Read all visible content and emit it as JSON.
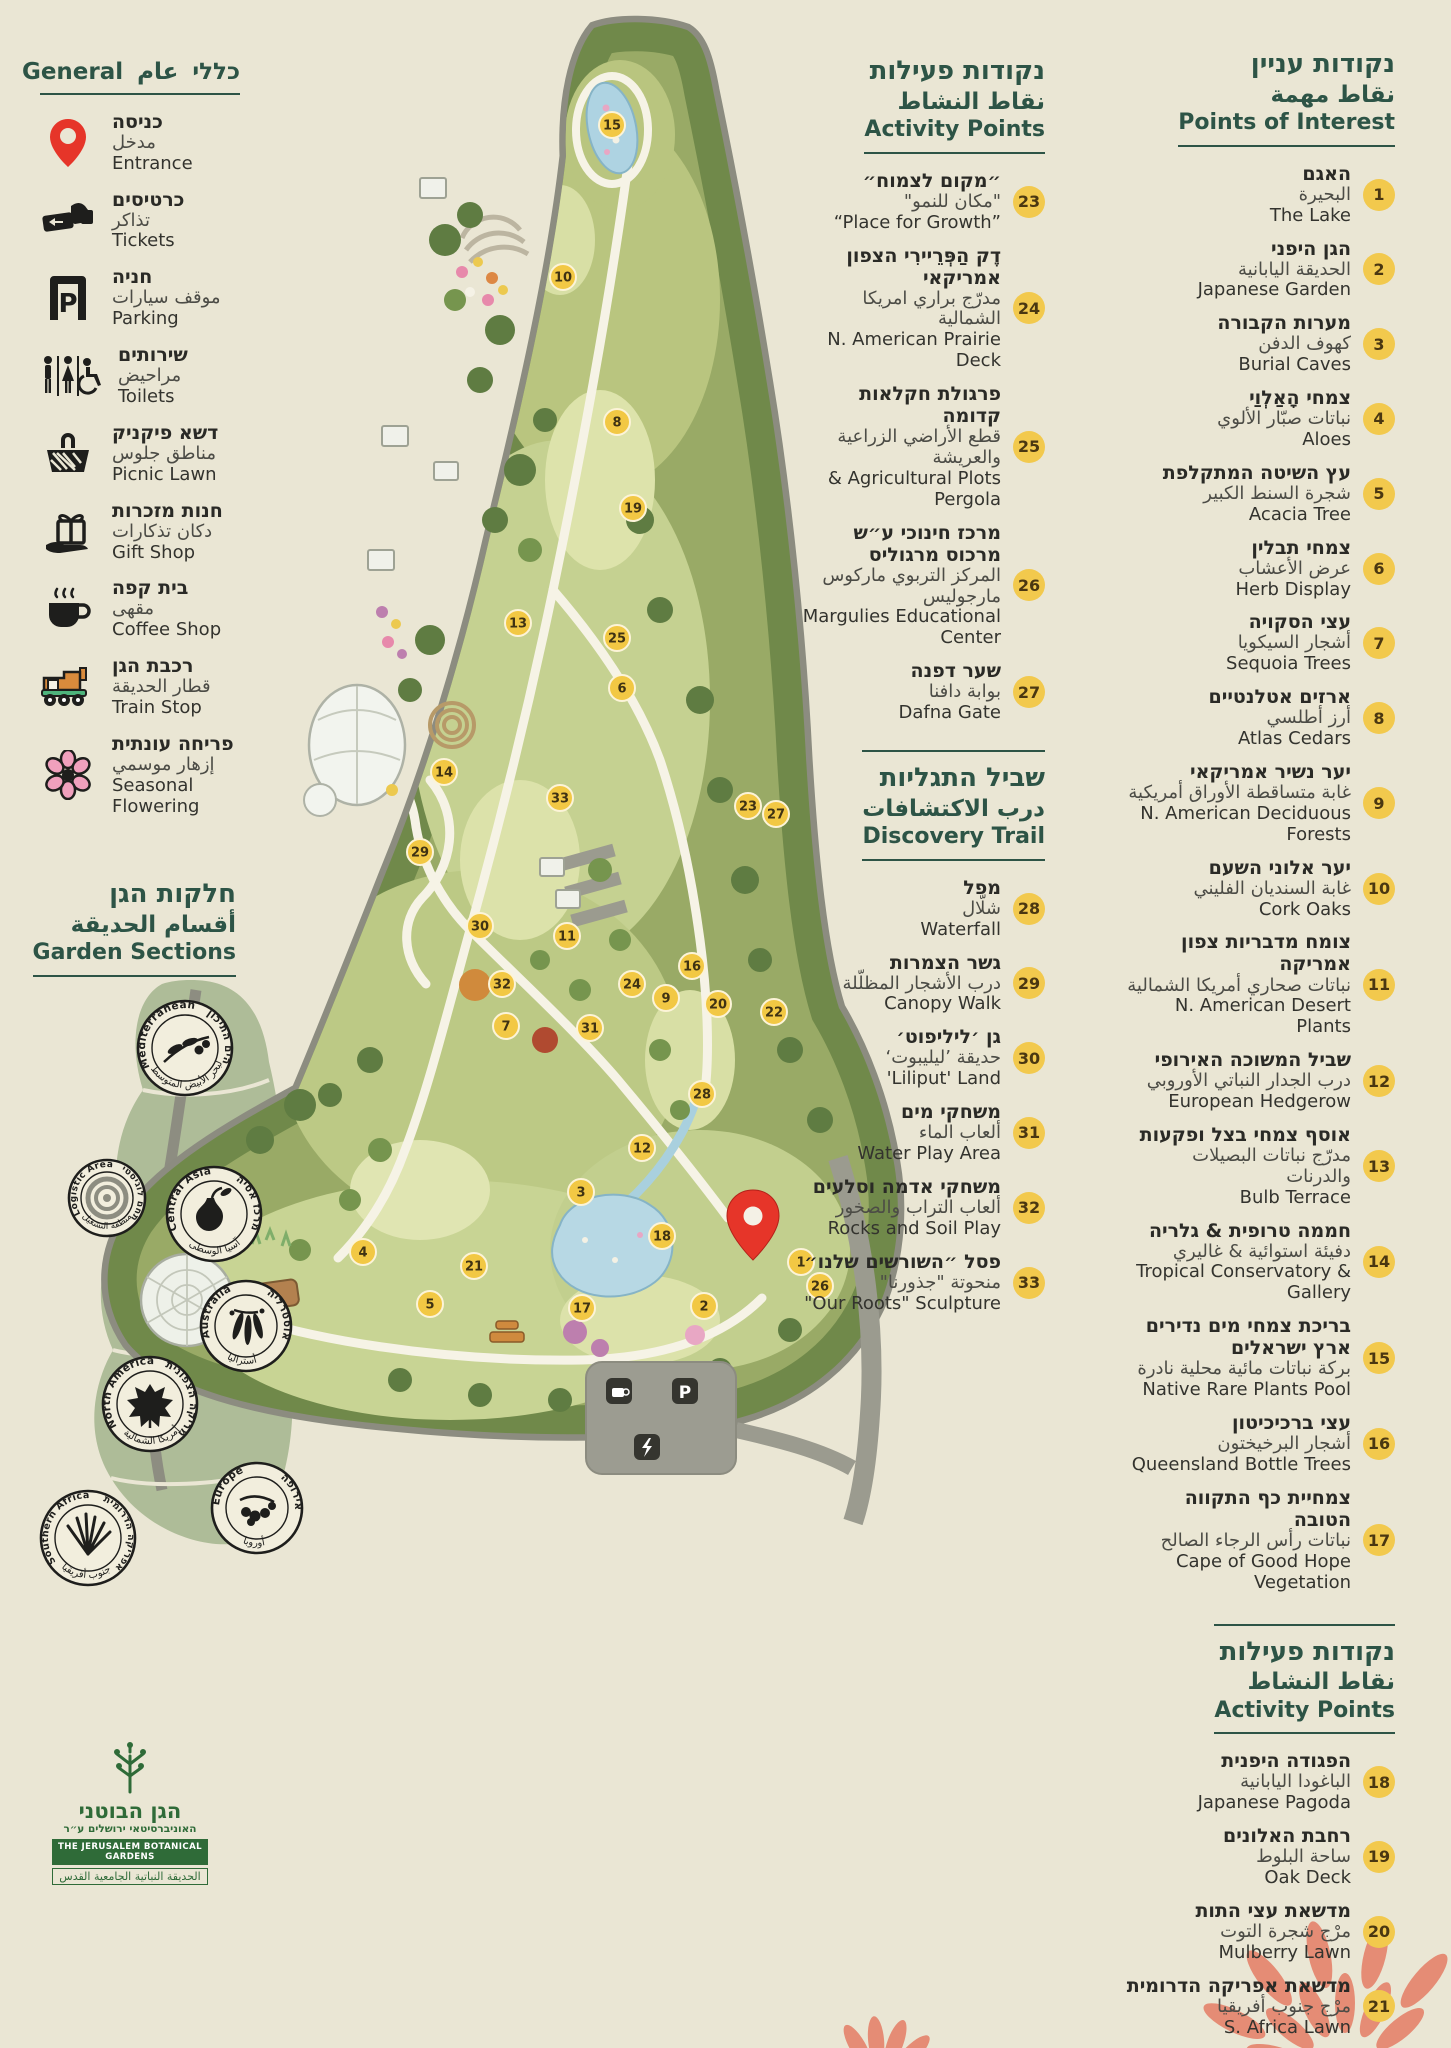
{
  "page": {
    "background": "#eae6d4",
    "accent_green": "#2d5446",
    "badge_yellow": "#f2c94d",
    "pin_red": "#e63529",
    "coral": "#e58c75"
  },
  "general_legend": {
    "title_he": "כללי",
    "title_ar": "عام",
    "title_en": "General",
    "items": [
      {
        "icon": "entrance-pin-icon",
        "he": "כניסה",
        "ar": "مدخل",
        "en": "Entrance"
      },
      {
        "icon": "tickets-icon",
        "he": "כרטיסים",
        "ar": "تذاكر",
        "en": "Tickets"
      },
      {
        "icon": "parking-icon",
        "he": "חניה",
        "ar": "موقف سيارات",
        "en": "Parking"
      },
      {
        "icon": "toilets-icon",
        "he": "שירותים",
        "ar": "مراحيض",
        "en": "Toilets"
      },
      {
        "icon": "picnic-basket-icon",
        "he": "דשא פיקניק",
        "ar": "مناطق جلوس",
        "en": "Picnic Lawn"
      },
      {
        "icon": "gift-shop-icon",
        "he": "חנות מזכרות",
        "ar": "دكان تذكارات",
        "en": "Gift Shop"
      },
      {
        "icon": "coffee-cup-icon",
        "he": "בית קפה",
        "ar": "مقهى",
        "en": "Coffee Shop"
      },
      {
        "icon": "train-icon",
        "he": "רכבת הגן",
        "ar": "قطار الحديقة",
        "en": "Train Stop"
      },
      {
        "icon": "flower-icon",
        "he": "פריחה עונתית",
        "ar": "إزهار موسمي",
        "en": "Seasonal Flowering"
      }
    ]
  },
  "garden_sections": {
    "title_he": "חלקות הגן",
    "title_ar": "أقسام الحديقة",
    "title_en": "Garden Sections",
    "badges": [
      {
        "en": "Mediterranean",
        "he": "הים התיכון",
        "ar": "البحر الأبيض المتوسط",
        "icon": "olive-branch-icon"
      },
      {
        "en": "Logistic Area",
        "he": "מתחם לוגיסטי",
        "ar": "منطقة التشغيل",
        "icon": "concentric-circles-icon"
      },
      {
        "en": "Central Asia",
        "he": "מרכז אסיה",
        "ar": "آسيا الوسطى",
        "icon": "pear-icon"
      },
      {
        "en": "Australia",
        "he": "אוסטרליה",
        "ar": "أستراليا",
        "icon": "eucalyptus-icon"
      },
      {
        "en": "North America",
        "he": "אמריקה הצפונית",
        "ar": "أمريكا الشمالية",
        "icon": "maple-leaf-icon"
      },
      {
        "en": "Europe",
        "he": "אירופה",
        "ar": "أوروبا",
        "icon": "oak-tree-icon"
      },
      {
        "en": "Southern Africa",
        "he": "אפריקה הדרומית",
        "ar": "جنوب أفريقيا",
        "icon": "aloe-icon"
      }
    ]
  },
  "points_of_interest": {
    "title_he": "נקודות עניין",
    "title_ar": "نقاط مهمة",
    "title_en": "Points of Interest",
    "items": [
      {
        "n": 1,
        "he": "האגם",
        "ar": "البحيرة",
        "en": "The Lake"
      },
      {
        "n": 2,
        "he": "הגן היפני",
        "ar": "الحديقة اليابانية",
        "en": "Japanese Garden"
      },
      {
        "n": 3,
        "he": "מערות הקבורה",
        "ar": "كهوف الدفن",
        "en": "Burial Caves"
      },
      {
        "n": 4,
        "he": "צמחי הָאַלְוַי",
        "ar": "نباتات صبّار الألوي",
        "en": "Aloes"
      },
      {
        "n": 5,
        "he": "עץ השיטה המתקלפת",
        "ar": "شجرة السنط الكبير",
        "en": "Acacia Tree"
      },
      {
        "n": 6,
        "he": "צמחי תבלין",
        "ar": "عرض الأعشاب",
        "en": "Herb Display"
      },
      {
        "n": 7,
        "he": "עצי הסקויה",
        "ar": "أشجار السيكويا",
        "en": "Sequoia Trees"
      },
      {
        "n": 8,
        "he": "ארזים אטלנטיים",
        "ar": "أرز أطلسي",
        "en": "Atlas Cedars"
      },
      {
        "n": 9,
        "he": "יער נשיר אמריקאי",
        "ar": "غابة متساقطة الأوراق أمريكية",
        "en": "N. American Deciduous Forests"
      },
      {
        "n": 10,
        "he": "יער אלוני השעם",
        "ar": "غابة السنديان الفليني",
        "en": "Cork Oaks"
      },
      {
        "n": 11,
        "he": "צומח מדבריות צפון אמריקה",
        "ar": "نباتات صحاري أمريكا الشمالية",
        "en": "N. American Desert Plants"
      },
      {
        "n": 12,
        "he": "שביל המשוכה האירופי",
        "ar": "درب الجدار النباتي الأوروبي",
        "en": "European Hedgerow"
      },
      {
        "n": 13,
        "he": "אוסף צמחי בצל ופקעות",
        "ar": "مدرّج نباتات البصيلات والدرنات",
        "en": "Bulb Terrace"
      },
      {
        "n": 14,
        "he": "חממה טרופית & גלריה",
        "ar": "دفيئة استوائية & غاليري",
        "en": "Tropical Conservatory & Gallery"
      },
      {
        "n": 15,
        "he": "בריכת צמחי מים נדירים ארץ ישראלים",
        "ar": "بركة نباتات مائية محلية نادرة",
        "en": "Native Rare Plants Pool"
      },
      {
        "n": 16,
        "he": "עצי ברכיכיטון",
        "ar": "أشجار البرخيختون",
        "en": "Queensland Bottle Trees"
      },
      {
        "n": 17,
        "he": "צמחיית כף התקווה הטובה",
        "ar": "نباتات رأس الرجاء الصالح",
        "en": "Cape of Good Hope Vegetation"
      }
    ]
  },
  "activity_points_center": {
    "title_he": "נקודות פעילות",
    "title_ar": "نقاط النشاط",
    "title_en": "Activity Points",
    "items": [
      {
        "n": 23,
        "he": "״מקום לצמוח״",
        "ar": "\"مكان للنمو\"",
        "en": "“Place for Growth”"
      },
      {
        "n": 24,
        "he": "דֶק הַפְּרֵיירִי הצפון אמריקאי",
        "ar": "مدرّج براري امريكا الشمالية",
        "en": "N. American Prairie Deck"
      },
      {
        "n": 25,
        "he": "פרגולת חקלאות קדומה",
        "ar": "قطع الأراضي الزراعية والعريشة",
        "en": "& Agricultural Plots Pergola"
      },
      {
        "n": 26,
        "he": "מרכז חינוכי ע״ש מרכוס מרגוליס",
        "ar": "المركز التربوي ماركوس مارجوليس",
        "en": "Margulies Educational Center"
      },
      {
        "n": 27,
        "he": "שער דפנה",
        "ar": "بوابة دافنا",
        "en": "Dafna Gate"
      }
    ]
  },
  "discovery_trail": {
    "title_he": "שביל התגליות",
    "title_ar": "درب الاكتشافات",
    "title_en": "Discovery Trail",
    "items": [
      {
        "n": 28,
        "he": "מפל",
        "ar": "شلّال",
        "en": "Waterfall"
      },
      {
        "n": 29,
        "he": "גשר הצמרות",
        "ar": "درب الأشجار المظلّلة",
        "en": "Canopy Walk"
      },
      {
        "n": 30,
        "he": "גן ׳ליליפוט׳",
        "ar": "حديقة ’ليليبوت‘",
        "en": "'Liliput' Land"
      },
      {
        "n": 31,
        "he": "משחקי מים",
        "ar": "ألعاب الماء",
        "en": "Water Play Area"
      },
      {
        "n": 32,
        "he": "משחקי אדמה וסלעים",
        "ar": "ألعاب التراب والصخور",
        "en": "Rocks and Soil Play"
      },
      {
        "n": 33,
        "he": "פסל ״השורשים שלנו״",
        "ar": "منحوتة \"جذورنا\"",
        "en": "\"Our Roots\" Sculpture"
      }
    ]
  },
  "activity_points_right": {
    "title_he": "נקודות פעילות",
    "title_ar": "نقاط النشاط",
    "title_en": "Activity Points",
    "items": [
      {
        "n": 18,
        "he": "הפגודה היפנית",
        "ar": "الباغودا اليابانية",
        "en": "Japanese Pagoda"
      },
      {
        "n": 19,
        "he": "רחבת האלונים",
        "ar": "ساحة البلوط",
        "en": "Oak Deck"
      },
      {
        "n": 20,
        "he": "מדשאת עצי התות",
        "ar": "مرْج شجرة التوت",
        "en": "Mulberry Lawn"
      },
      {
        "n": 21,
        "he": "מדשאת אפריקה הדרומית",
        "ar": "مرْج جنوب أفريقيا",
        "en": "S. Africa Lawn"
      },
      {
        "n": 22,
        "he": "רחבת האקליפטוסים",
        "ar": "ساحة أشجار الأوكالبتوس",
        "en": "Eucalyptus Plaza"
      }
    ]
  },
  "logo": {
    "he_title": "הגן הבוטני",
    "he_sub": "האוניברסיטאי ירושלים ע״ר",
    "en": "THE JERUSALEM BOTANICAL GARDENS",
    "ar": "الحديقة النباتية الجامعية القدس"
  },
  "map": {
    "parking_label": "P"
  },
  "map_markers": [
    {
      "n": 1,
      "x": 801,
      "y": 1262
    },
    {
      "n": 2,
      "x": 704,
      "y": 1306
    },
    {
      "n": 3,
      "x": 581,
      "y": 1192
    },
    {
      "n": 4,
      "x": 363,
      "y": 1252
    },
    {
      "n": 5,
      "x": 430,
      "y": 1304
    },
    {
      "n": 6,
      "x": 622,
      "y": 688
    },
    {
      "n": 7,
      "x": 506,
      "y": 1026
    },
    {
      "n": 8,
      "x": 617,
      "y": 422
    },
    {
      "n": 9,
      "x": 666,
      "y": 998
    },
    {
      "n": 10,
      "x": 563,
      "y": 277
    },
    {
      "n": 11,
      "x": 567,
      "y": 936
    },
    {
      "n": 12,
      "x": 642,
      "y": 1148
    },
    {
      "n": 13,
      "x": 518,
      "y": 623
    },
    {
      "n": 14,
      "x": 444,
      "y": 772
    },
    {
      "n": 15,
      "x": 612,
      "y": 125
    },
    {
      "n": 16,
      "x": 692,
      "y": 966
    },
    {
      "n": 17,
      "x": 582,
      "y": 1308
    },
    {
      "n": 18,
      "x": 662,
      "y": 1236
    },
    {
      "n": 19,
      "x": 633,
      "y": 508
    },
    {
      "n": 20,
      "x": 718,
      "y": 1004
    },
    {
      "n": 21,
      "x": 474,
      "y": 1266
    },
    {
      "n": 22,
      "x": 774,
      "y": 1012
    },
    {
      "n": 23,
      "x": 748,
      "y": 806
    },
    {
      "n": 24,
      "x": 632,
      "y": 984
    },
    {
      "n": 25,
      "x": 617,
      "y": 638
    },
    {
      "n": 26,
      "x": 820,
      "y": 1286
    },
    {
      "n": 27,
      "x": 776,
      "y": 814
    },
    {
      "n": 28,
      "x": 702,
      "y": 1094
    },
    {
      "n": 29,
      "x": 420,
      "y": 852
    },
    {
      "n": 30,
      "x": 480,
      "y": 926
    },
    {
      "n": 31,
      "x": 590,
      "y": 1028
    },
    {
      "n": 32,
      "x": 502,
      "y": 984
    },
    {
      "n": 33,
      "x": 560,
      "y": 798
    }
  ]
}
